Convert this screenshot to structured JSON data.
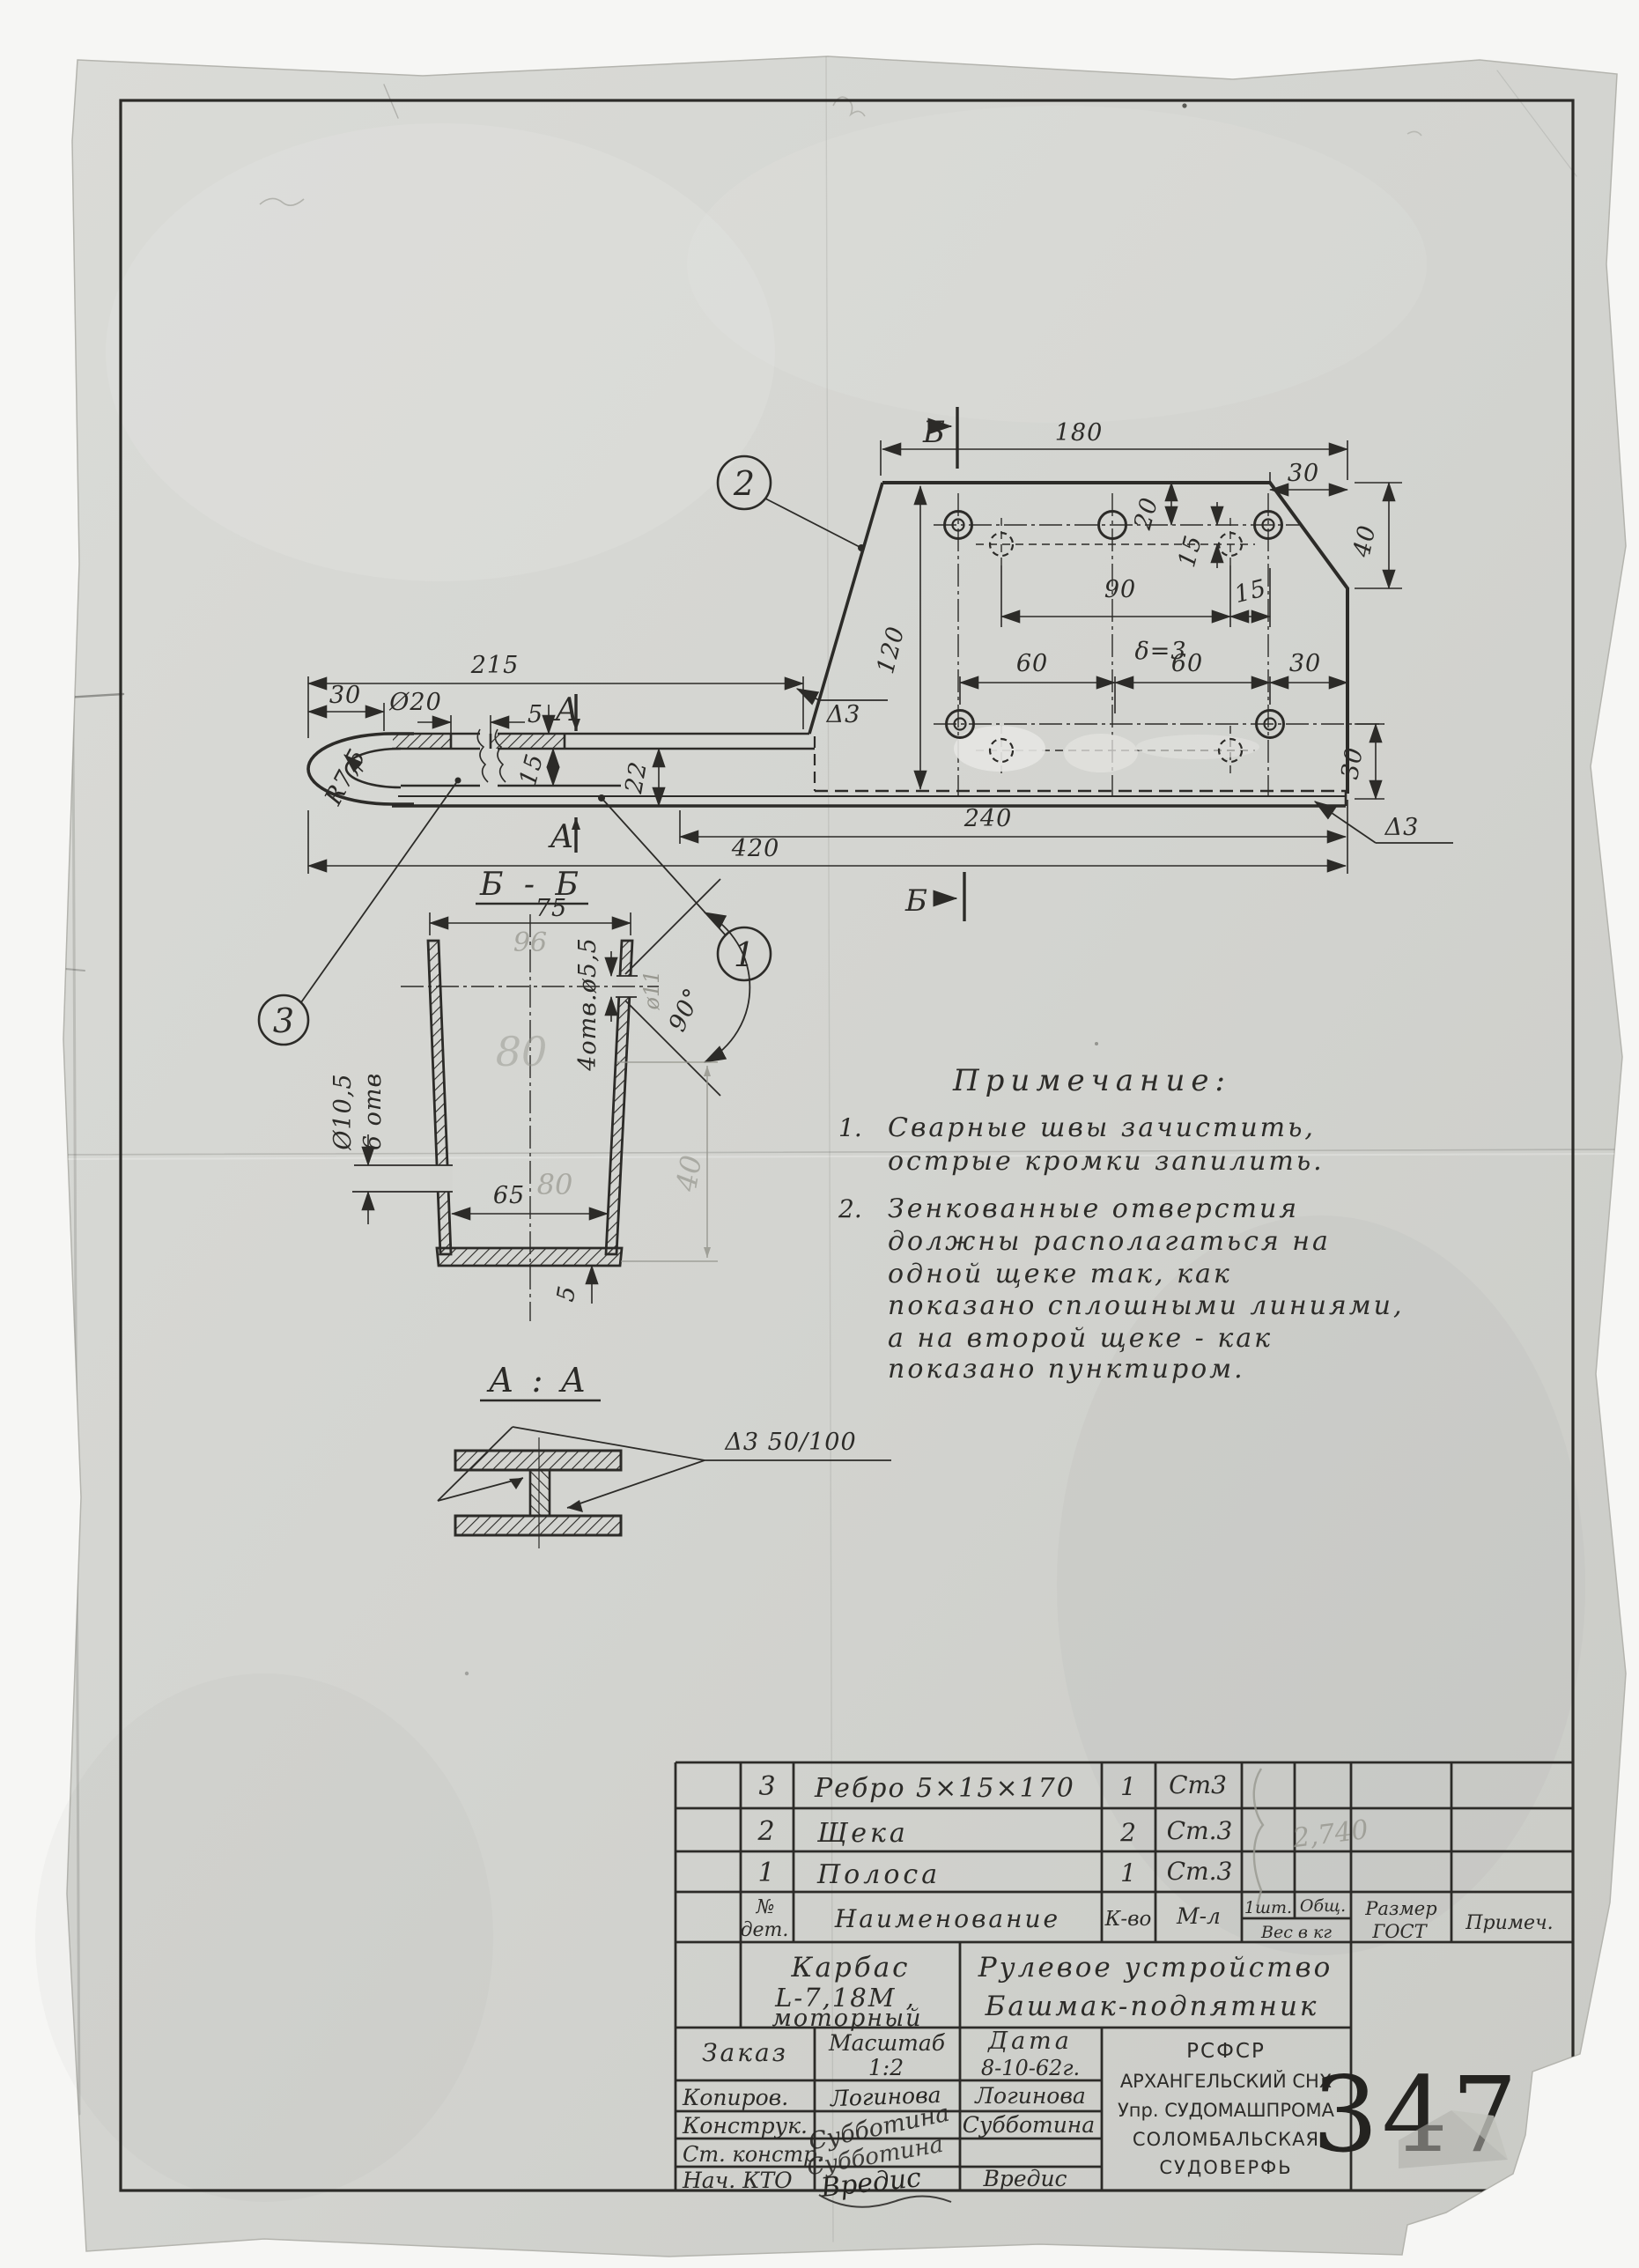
{
  "sheet": {
    "drawing_number": "3475",
    "ink_color": "#2c2b28",
    "pencil_color": "#97978f",
    "paper_color": "#d3d4d0"
  },
  "callouts": {
    "one": "1",
    "two": "2",
    "three": "3"
  },
  "plate_view": {
    "section_marker": "Б",
    "dims": {
      "d180": "180",
      "d30_top": "30",
      "d40": "40",
      "d20": "20",
      "d15_v": "15",
      "d90": "90",
      "d15_h": "15",
      "thickness": "δ=3",
      "d120": "120",
      "d60_a": "60",
      "d60_b": "60",
      "d30_chain": "30",
      "d30_right": "30",
      "weld_left": "Δ3",
      "weld_right": "Δ3"
    }
  },
  "strip_view": {
    "section_marker": "А",
    "dims": {
      "d215": "215",
      "d30": "30",
      "dia20": "Ø20",
      "radius": "R7,5",
      "d5": "5",
      "d15": "15",
      "d22": "22",
      "d240": "240",
      "d420": "420"
    }
  },
  "section_bb": {
    "title": "Б - Б",
    "d75": "75",
    "pencil_96": "96",
    "holes_small": "4отв.ø5,5",
    "pencil_dia11": "ø11",
    "angle": "90°",
    "pencil_80_mid": "80",
    "dia_left_line1": "Ø10,5",
    "dia_left_line2": "6 отв",
    "d65": "65",
    "pencil_80": "80",
    "pencil_40": "40",
    "d5": "5"
  },
  "section_aa": {
    "title": "А : А",
    "weld_note": "Δ3  50/100"
  },
  "notes": {
    "title": "Примечание:",
    "items": [
      {
        "num": "1.",
        "lines": [
          "Сварные швы зачистить,",
          "острые кромки запилить."
        ]
      },
      {
        "num": "2.",
        "lines": [
          "Зенкованные отверстия",
          "должны располагаться на",
          "одной щеке так, как",
          "показано сплошными линиями,",
          "а на второй щеке - как",
          "показано пунктиром."
        ]
      }
    ]
  },
  "title_block": {
    "parts": [
      {
        "no": "3",
        "name": "Ребро 5×15×170",
        "qty": "1",
        "material": "Ст3"
      },
      {
        "no": "2",
        "name": "Щека",
        "qty": "2",
        "material": "Ст.3"
      },
      {
        "no": "1",
        "name": "Полоса",
        "qty": "1",
        "material": "Ст.3"
      }
    ],
    "pencil_weight": "2,740",
    "headers": {
      "no1": "№",
      "no2": "дет.",
      "name": "Наименование",
      "qty": "К-во",
      "material": "М-л",
      "per_piece": "1шт.",
      "total": "Общ.",
      "weight": "Вес в кг",
      "size1": "Размер",
      "size2": "ГОСТ",
      "note": "Примеч."
    },
    "product": {
      "line1": "Карбас",
      "line2": "L-7,18М ,",
      "line3": "моторный"
    },
    "title": {
      "line1": "Рулевое устройство",
      "line2": "Башмак-подпятник"
    },
    "order_label": "Заказ",
    "scale_label": "Масштаб",
    "scale_value": "1:2",
    "date_label": "Дата",
    "date_value": "8-10-62г.",
    "org": [
      "РСФСР",
      "АРХАНГЕЛЬСКИЙ СНХ",
      "Упр. СУДОМАШПРОМА",
      "СОЛОМБАЛЬСКАЯ",
      "СУДОВЕРФЬ"
    ],
    "number": "3475",
    "sig_rows": [
      {
        "label": "Копиров.",
        "signature": "Логинова",
        "name": "Логинова"
      },
      {
        "label": "Конструк.",
        "signature": "Субботина",
        "name": "Субботина"
      },
      {
        "label": "Ст. констр.",
        "signature": "Субботина",
        "name": ""
      },
      {
        "label": "Нач. КТО",
        "signature": "Вредис",
        "name": "Вредис"
      }
    ]
  }
}
